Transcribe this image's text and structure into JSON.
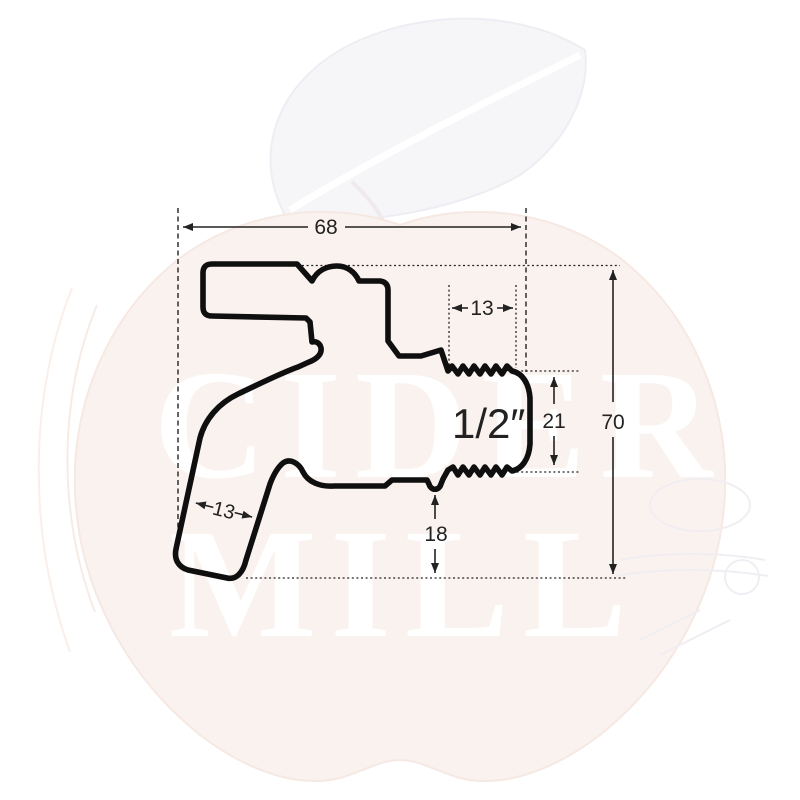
{
  "page": {
    "width": "800",
    "height": "800",
    "background": "#ffffff"
  },
  "watermark": {
    "word_top": "CIDER",
    "word_bottom": "MILL",
    "apple_color": "#faf2ee",
    "leaf_color": "#f6f5f8",
    "sketch_color": "#f0eef3",
    "text_color": "#ffffff"
  },
  "diagram": {
    "subject": "faucet-side-view-technical-drawing",
    "outline_color": "#0f0f0f",
    "dimension_color": "#222222",
    "labels": {
      "overall_width": "68",
      "thread_length": "13",
      "connection_size": "1/2″",
      "thread_diameter": "21",
      "overall_height": "70",
      "spout_diameter": "13",
      "outlet_clearance": "18"
    }
  }
}
